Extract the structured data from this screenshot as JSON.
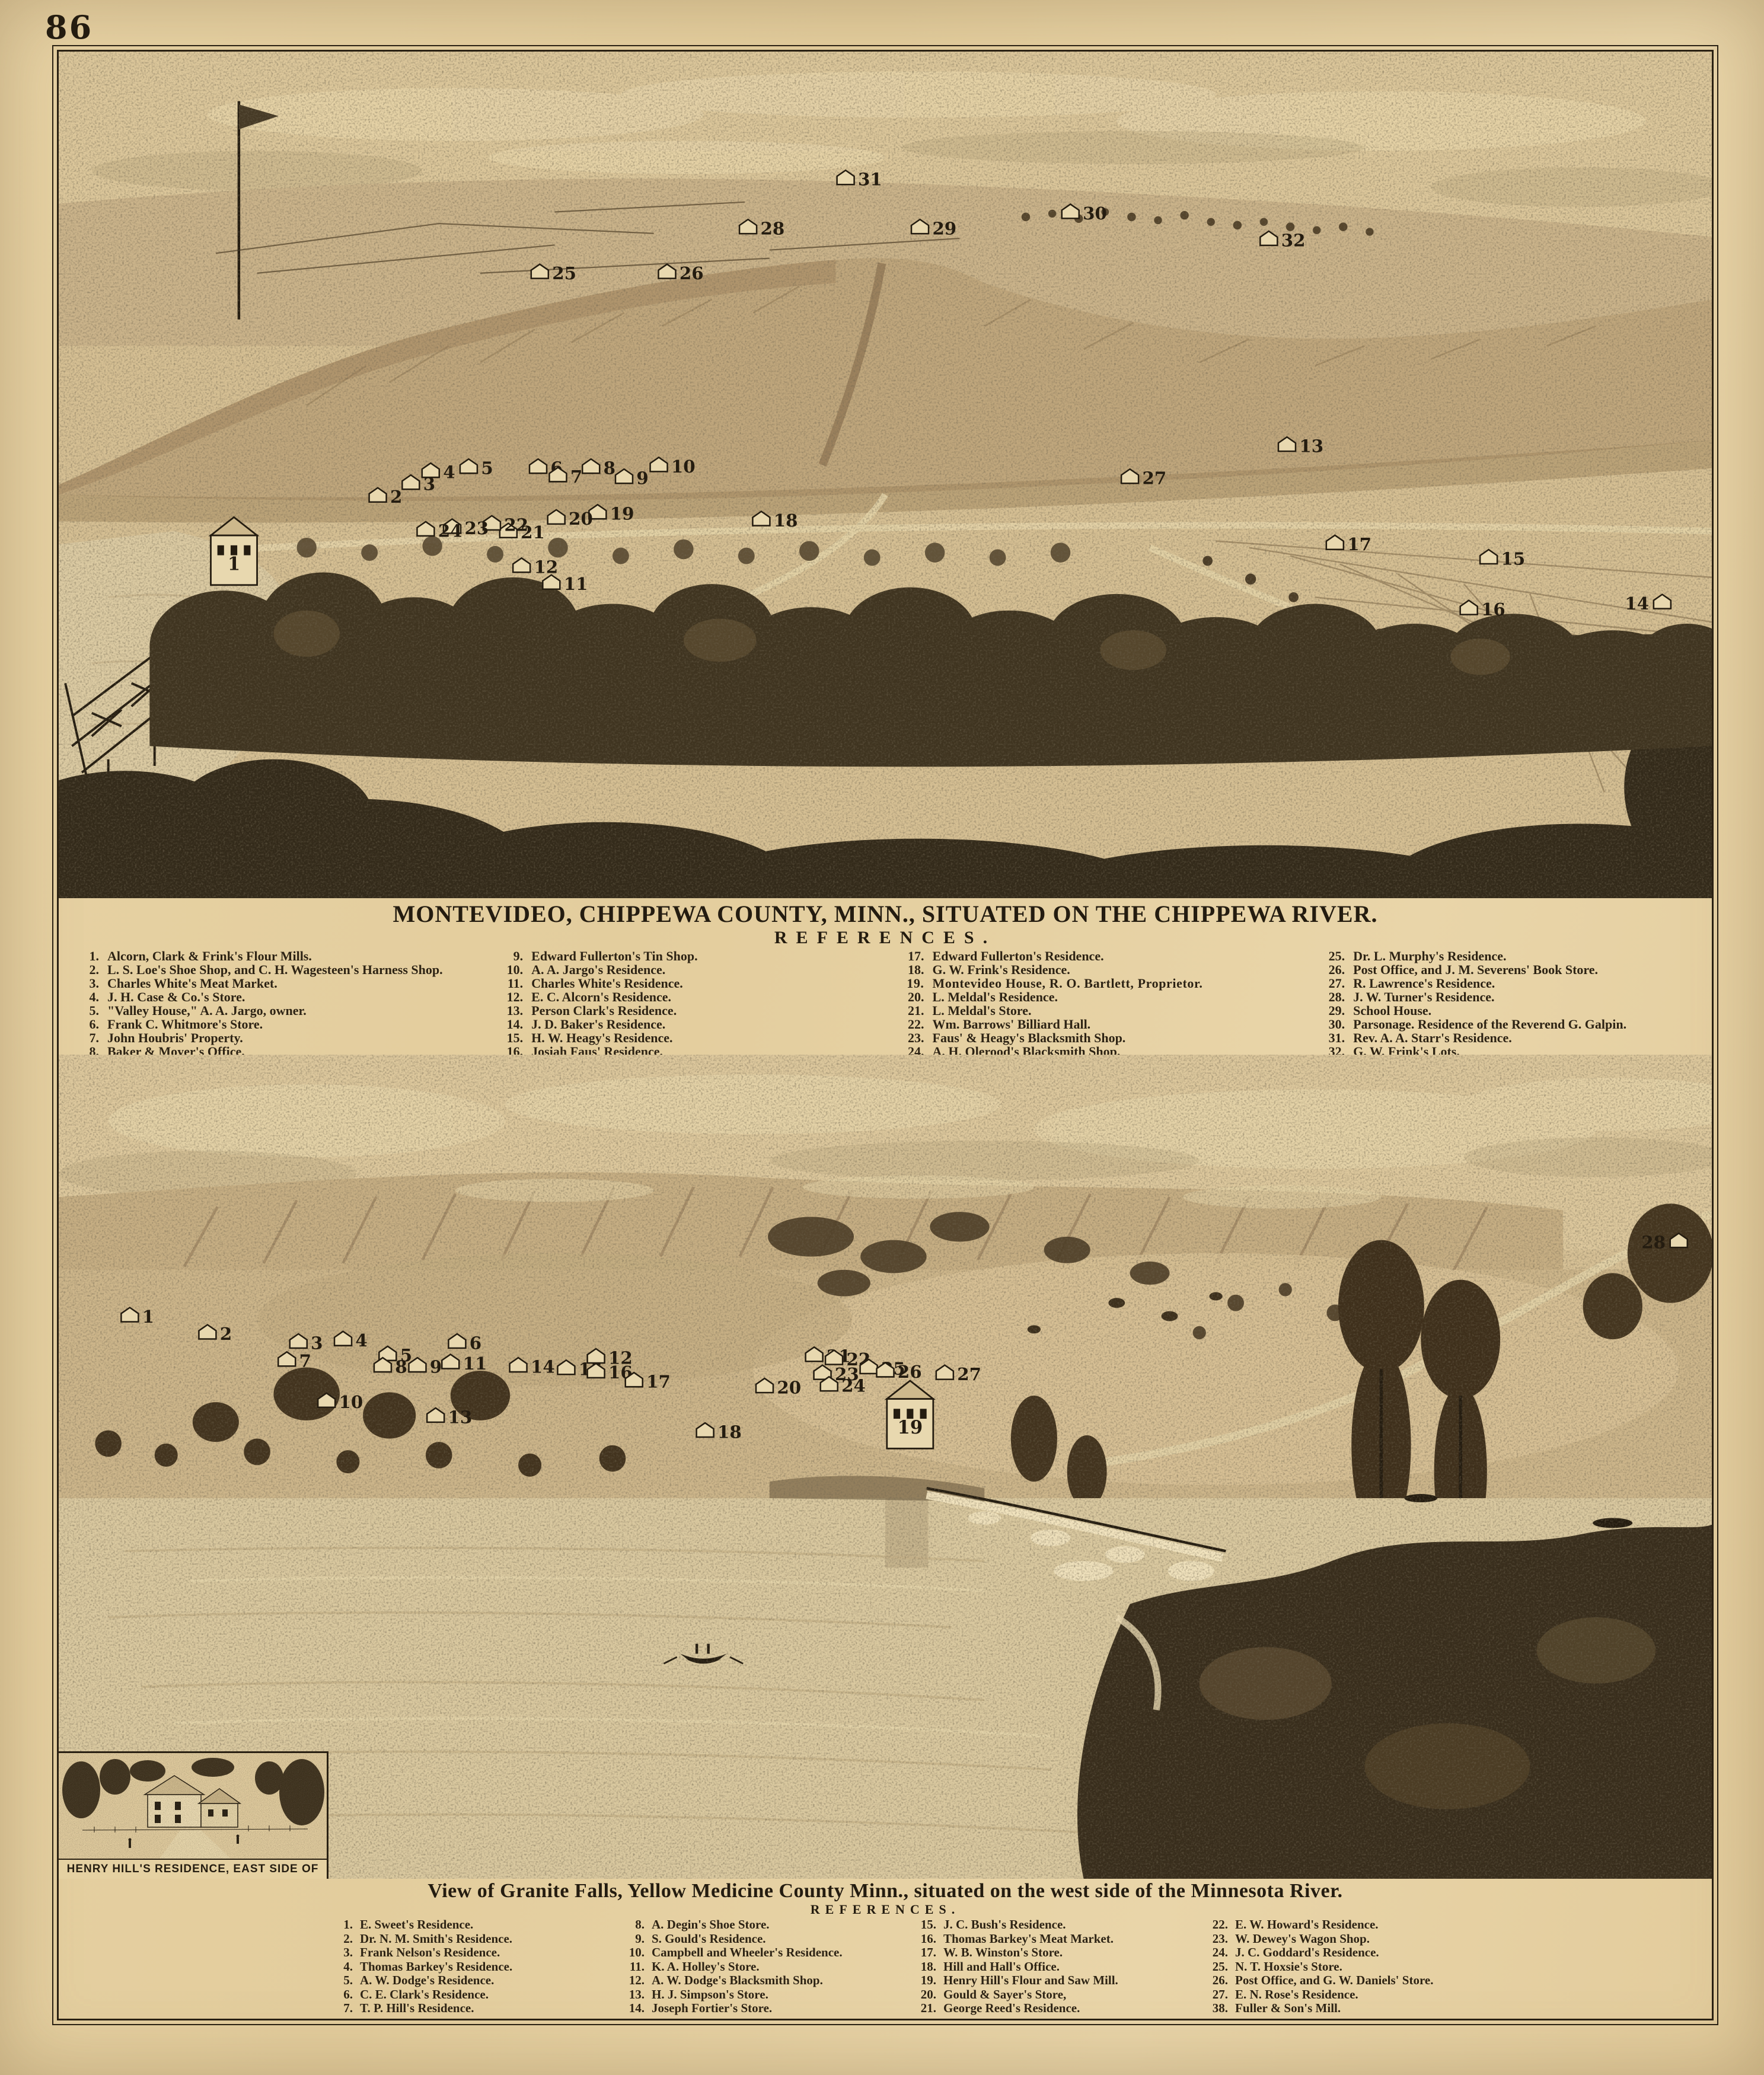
{
  "page": {
    "number": "86"
  },
  "palette": {
    "paper": "#e5d0a2",
    "engraving_base": "#d5bf93",
    "ink": "#2a2113",
    "dark_foliage": "#3a3020",
    "hill_tone": "#bfa67c",
    "water_tone": "#d9c89f"
  },
  "montevideo": {
    "title": "MONTEVIDEO, CHIPPEWA COUNTY, MINN., SITUATED ON THE CHIPPEWA RIVER.",
    "references_heading": "REFERENCES.",
    "columns": [
      [
        {
          "n": "1.",
          "t": "Alcorn, Clark & Frink's Flour Mills."
        },
        {
          "n": "2.",
          "t": "L. S. Loe's Shoe Shop, and C. H. Wagesteen's Harness Shop."
        },
        {
          "n": "3.",
          "t": "Charles White's Meat Market."
        },
        {
          "n": "4.",
          "t": "J. H. Case & Co.'s Store."
        },
        {
          "n": "5.",
          "t": "\"Valley House,\" A. A. Jargo, owner."
        },
        {
          "n": "6.",
          "t": "Frank C. Whitmore's Store."
        },
        {
          "n": "7.",
          "t": "John Houbris' Property."
        },
        {
          "n": "8.",
          "t": "Baker & Moyer's Office."
        }
      ],
      [
        {
          "n": "9.",
          "t": "Edward Fullerton's Tin Shop."
        },
        {
          "n": "10.",
          "t": "A. A. Jargo's Residence."
        },
        {
          "n": "11.",
          "t": "Charles White's Residence."
        },
        {
          "n": "12.",
          "t": "E. C. Alcorn's Residence."
        },
        {
          "n": "13.",
          "t": "Person Clark's Residence."
        },
        {
          "n": "14.",
          "t": "J. D. Baker's Residence."
        },
        {
          "n": "15.",
          "t": "H. W. Heagy's Residence."
        },
        {
          "n": "16.",
          "t": "Josiah Faus' Residence."
        }
      ],
      [
        {
          "n": "17.",
          "t": "Edward Fullerton's Residence."
        },
        {
          "n": "18.",
          "t": "G. W. Frink's Residence."
        },
        {
          "n": "19.",
          "t": "Montevideo House, R. O. Bartlett, Proprietor.",
          "bold": true
        },
        {
          "n": "20.",
          "t": "L. Meldal's Residence."
        },
        {
          "n": "21.",
          "t": "L. Meldal's Store."
        },
        {
          "n": "22.",
          "t": "Wm. Barrows' Billiard Hall."
        },
        {
          "n": "23.",
          "t": "Faus' & Heagy's Blacksmith Shop."
        },
        {
          "n": "24.",
          "t": "A. H. Olerood's Blacksmith Shop."
        }
      ],
      [
        {
          "n": "25.",
          "t": "Dr. L. Murphy's Residence."
        },
        {
          "n": "26.",
          "t": "Post Office, and J. M. Severens' Book Store."
        },
        {
          "n": "27.",
          "t": "R. Lawrence's Residence."
        },
        {
          "n": "28.",
          "t": "J. W. Turner's Residence."
        },
        {
          "n": "29.",
          "t": "School House."
        },
        {
          "n": "30.",
          "t": "Parsonage.  Residence of the Reverend G. Galpin."
        },
        {
          "n": "31.",
          "t": "Rev. A. A. Starr's Residence."
        },
        {
          "n": "32.",
          "t": "G. W. Frink's Lots."
        }
      ]
    ],
    "markers": [
      {
        "n": "1",
        "x": 10.6,
        "y": 63.0,
        "mill": true
      },
      {
        "n": "2",
        "x": 19.3,
        "y": 53.2
      },
      {
        "n": "3",
        "x": 21.3,
        "y": 51.7
      },
      {
        "n": "4",
        "x": 22.5,
        "y": 50.3
      },
      {
        "n": "5",
        "x": 24.8,
        "y": 49.8
      },
      {
        "n": "6",
        "x": 29.0,
        "y": 49.8
      },
      {
        "n": "7",
        "x": 30.2,
        "y": 50.8
      },
      {
        "n": "8",
        "x": 32.2,
        "y": 49.8
      },
      {
        "n": "9",
        "x": 34.2,
        "y": 51.0
      },
      {
        "n": "10",
        "x": 36.3,
        "y": 49.6
      },
      {
        "n": "11",
        "x": 29.8,
        "y": 63.5
      },
      {
        "n": "12",
        "x": 28.0,
        "y": 61.5
      },
      {
        "n": "13",
        "x": 74.3,
        "y": 47.2
      },
      {
        "n": "14",
        "x": 97.0,
        "y": 65.8
      },
      {
        "n": "15",
        "x": 86.5,
        "y": 60.5
      },
      {
        "n": "16",
        "x": 85.3,
        "y": 66.5
      },
      {
        "n": "17",
        "x": 77.2,
        "y": 58.8
      },
      {
        "n": "18",
        "x": 42.5,
        "y": 56.0
      },
      {
        "n": "19",
        "x": 32.6,
        "y": 55.2
      },
      {
        "n": "20",
        "x": 30.1,
        "y": 55.8
      },
      {
        "n": "21",
        "x": 27.2,
        "y": 57.4
      },
      {
        "n": "22",
        "x": 26.2,
        "y": 56.5
      },
      {
        "n": "23",
        "x": 23.8,
        "y": 56.9
      },
      {
        "n": "24",
        "x": 22.2,
        "y": 57.2
      },
      {
        "n": "25",
        "x": 29.1,
        "y": 26.8
      },
      {
        "n": "26",
        "x": 36.8,
        "y": 26.8
      },
      {
        "n": "27",
        "x": 64.8,
        "y": 51.0
      },
      {
        "n": "28",
        "x": 41.7,
        "y": 21.5
      },
      {
        "n": "29",
        "x": 52.1,
        "y": 21.5
      },
      {
        "n": "30",
        "x": 61.2,
        "y": 19.7
      },
      {
        "n": "31",
        "x": 47.6,
        "y": 15.7
      },
      {
        "n": "32",
        "x": 73.2,
        "y": 22.9
      }
    ]
  },
  "granite_falls": {
    "title": "View of Granite Falls, Yellow Medicine County Minn., situated on the west side of the Minnesota River.",
    "references_heading": "REFERENCES.",
    "columns": [
      [
        {
          "n": "1.",
          "t": "E. Sweet's Residence."
        },
        {
          "n": "2.",
          "t": "Dr. N. M. Smith's Residence."
        },
        {
          "n": "3.",
          "t": "Frank Nelson's Residence."
        },
        {
          "n": "4.",
          "t": "Thomas Barkey's Residence."
        },
        {
          "n": "5.",
          "t": "A. W. Dodge's Residence."
        },
        {
          "n": "6.",
          "t": "C. E. Clark's Residence."
        },
        {
          "n": "7.",
          "t": "T. P. Hill's Residence."
        }
      ],
      [
        {
          "n": "8.",
          "t": "A. Degin's Shoe Store."
        },
        {
          "n": "9.",
          "t": "S. Gould's Residence."
        },
        {
          "n": "10.",
          "t": "Campbell and Wheeler's Residence."
        },
        {
          "n": "11.",
          "t": "K. A. Holley's Store."
        },
        {
          "n": "12.",
          "t": "A. W. Dodge's Blacksmith Shop."
        },
        {
          "n": "13.",
          "t": "H. J. Simpson's Store."
        },
        {
          "n": "14.",
          "t": "Joseph Fortier's Store."
        }
      ],
      [
        {
          "n": "15.",
          "t": "J. C. Bush's Residence."
        },
        {
          "n": "16.",
          "t": "Thomas Barkey's Meat Market."
        },
        {
          "n": "17.",
          "t": "W. B. Winston's Store."
        },
        {
          "n": "18.",
          "t": "Hill and Hall's Office."
        },
        {
          "n": "19.",
          "t": "Henry Hill's Flour and Saw Mill."
        },
        {
          "n": "20.",
          "t": "Gould & Sayer's Store,"
        },
        {
          "n": "21.",
          "t": "George Reed's Residence."
        }
      ],
      [
        {
          "n": "22.",
          "t": "E. W. Howard's Residence."
        },
        {
          "n": "23.",
          "t": "W. Dewey's Wagon Shop."
        },
        {
          "n": "24.",
          "t": "J. C. Goddard's Residence."
        },
        {
          "n": "25.",
          "t": "N. T. Hoxsie's Store."
        },
        {
          "n": "26.",
          "t": "Post Office, and G. W. Daniels' Store."
        },
        {
          "n": "27.",
          "t": "E. N. Rose's Residence."
        },
        {
          "n": "38.",
          "t": "Fuller & Son's Mill."
        }
      ]
    ],
    "markers": [
      {
        "n": "1",
        "x": 4.3,
        "y": 32.4
      },
      {
        "n": "2",
        "x": 9.0,
        "y": 34.5
      },
      {
        "n": "3",
        "x": 14.5,
        "y": 35.6
      },
      {
        "n": "4",
        "x": 17.2,
        "y": 35.3
      },
      {
        "n": "5",
        "x": 19.9,
        "y": 37.1
      },
      {
        "n": "6",
        "x": 24.1,
        "y": 35.6
      },
      {
        "n": "7",
        "x": 13.8,
        "y": 37.8
      },
      {
        "n": "8",
        "x": 19.6,
        "y": 38.5
      },
      {
        "n": "9",
        "x": 21.7,
        "y": 38.5
      },
      {
        "n": "10",
        "x": 16.2,
        "y": 42.8
      },
      {
        "n": "11",
        "x": 23.7,
        "y": 38.1
      },
      {
        "n": "12",
        "x": 32.5,
        "y": 37.4
      },
      {
        "n": "13",
        "x": 22.8,
        "y": 44.6
      },
      {
        "n": "14",
        "x": 27.8,
        "y": 38.5
      },
      {
        "n": "15",
        "x": 30.7,
        "y": 38.8
      },
      {
        "n": "16",
        "x": 32.5,
        "y": 39.2
      },
      {
        "n": "17",
        "x": 34.8,
        "y": 40.3
      },
      {
        "n": "18",
        "x": 39.1,
        "y": 46.4
      },
      {
        "n": "19",
        "x": 51.5,
        "y": 47.8,
        "mill": true
      },
      {
        "n": "20",
        "x": 42.7,
        "y": 41.0
      },
      {
        "n": "21",
        "x": 45.7,
        "y": 37.2
      },
      {
        "n": "22",
        "x": 46.9,
        "y": 37.6
      },
      {
        "n": "23",
        "x": 46.2,
        "y": 39.4
      },
      {
        "n": "24",
        "x": 46.6,
        "y": 40.8
      },
      {
        "n": "25",
        "x": 49.0,
        "y": 38.7
      },
      {
        "n": "26",
        "x": 50.0,
        "y": 39.1
      },
      {
        "n": "27",
        "x": 53.6,
        "y": 39.4
      },
      {
        "n": "28",
        "x": 98.0,
        "y": 23.4
      }
    ]
  },
  "inset": {
    "caption": "HENRY HILL'S RESIDENCE, EAST SIDE OF THE RIVER."
  }
}
